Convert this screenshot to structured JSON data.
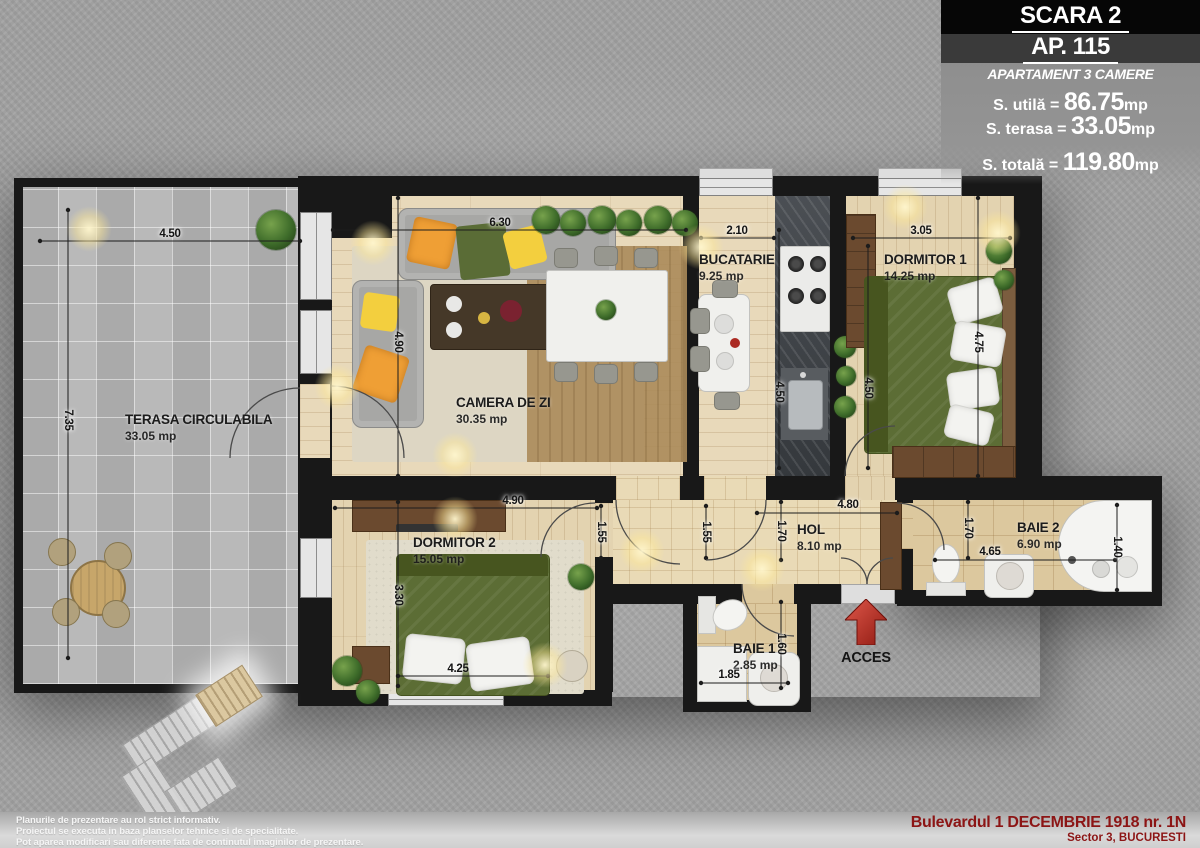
{
  "header": {
    "scara": "SCARA 2",
    "ap": "AP. 115",
    "subtitle": "APARTAMENT 3 CAMERE",
    "areas": {
      "utila_label": "S. utilă = ",
      "utila_value": "86.75",
      "utila_unit": "mp",
      "terasa_label": "S. terasa = ",
      "terasa_value": "33.05",
      "terasa_unit": "mp",
      "totala_label": "S. totală = ",
      "totala_value": "119.80",
      "totala_unit": "mp"
    }
  },
  "rooms": {
    "terasa": {
      "name": "TERASA CIRCULABILA",
      "area": "33.05 mp"
    },
    "living": {
      "name": "CAMERA DE ZI",
      "area": "30.35 mp"
    },
    "bucatarie": {
      "name": "BUCATARIE",
      "area": "9.25 mp"
    },
    "dormitor1": {
      "name": "DORMITOR 1",
      "area": "14.25 mp"
    },
    "dormitor2": {
      "name": "DORMITOR 2",
      "area": "15.05 mp"
    },
    "hol": {
      "name": "HOL",
      "area": "8.10 mp"
    },
    "baie1": {
      "name": "BAIE 1",
      "area": "2.85 mp"
    },
    "baie2": {
      "name": "BAIE 2",
      "area": "6.90 mp"
    }
  },
  "dimensions": {
    "terasa_top": "4.50",
    "terasa_left": "7.35",
    "living_top": "6.30",
    "living_height": "4.90",
    "bucatarie_top": "2.10",
    "bucatarie_height": "4.50",
    "dormitor1_top": "3.05",
    "dormitor1_height": "4.50",
    "dormitor1_right": "4.75",
    "dormitor2_top": "4.90",
    "dormitor2_height": "3.30",
    "dormitor2_bed": "4.25",
    "dormitor2_right": "1.55",
    "hol_left": "1.55",
    "hol_entry": "1.70",
    "hol_width": "4.80",
    "baie2_left": "1.70",
    "baie2_width": "4.65",
    "baie2_right": "1.40",
    "baie1_height": "1.60",
    "baie1_width": "1.85"
  },
  "acces": {
    "label": "ACCES"
  },
  "footer": {
    "disclaimer": [
      "Planurile de prezentare au rol strict informativ.",
      "Proiectul se executa in baza planselor tehnice si de specialitate.",
      "Pot aparea modificari sau diferente fata de continutul imaginilor de prezentare."
    ],
    "address_line1": "Bulevardul 1 DECEMBRIE 1918 nr. 1N",
    "address_line2": "Sector 3, BUCURESTI"
  },
  "colors": {
    "wall": "#181818",
    "bed_green": "#5c6d35",
    "plant_green": "#3e6c2a",
    "arrow_red": "#b3362c",
    "address_red": "#8c1515"
  }
}
